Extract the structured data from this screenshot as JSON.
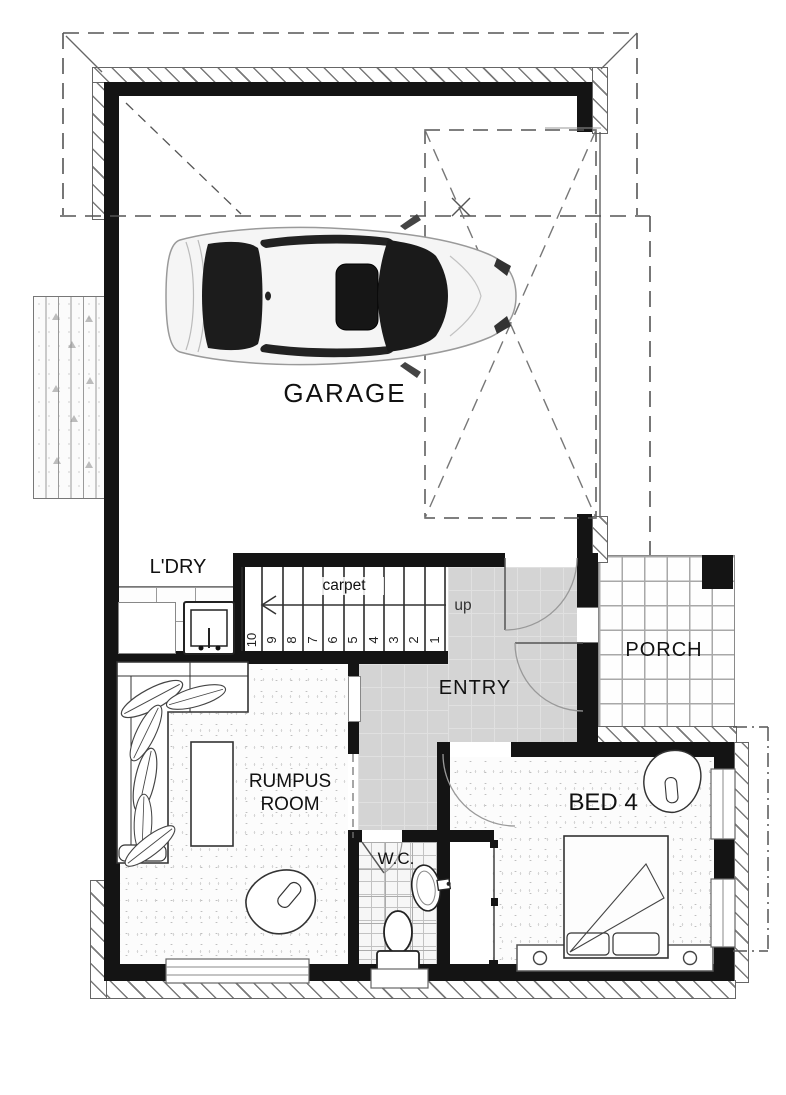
{
  "plan": {
    "rooms": {
      "garage": {
        "label": "GARAGE"
      },
      "laundry": {
        "label": "L'DRY"
      },
      "entry": {
        "label": "ENTRY"
      },
      "porch": {
        "label": "PORCH"
      },
      "rumpus": {
        "label_line1": "RUMPUS",
        "label_line2": "ROOM"
      },
      "bed4": {
        "label": "BED 4"
      },
      "wc": {
        "label": "W.C."
      }
    },
    "stairs": {
      "floor_label": "carpet",
      "direction_label": "up",
      "numbers": [
        "10",
        "9",
        "8",
        "7",
        "6",
        "5",
        "4",
        "3",
        "2",
        "1"
      ]
    },
    "colors": {
      "wall": "#141414",
      "entry_tile": "#d4d4d4",
      "porch_grout": "#a8a8a8",
      "dashed_line": "#555555",
      "carpet_speckle": "#bfbfbf"
    }
  }
}
